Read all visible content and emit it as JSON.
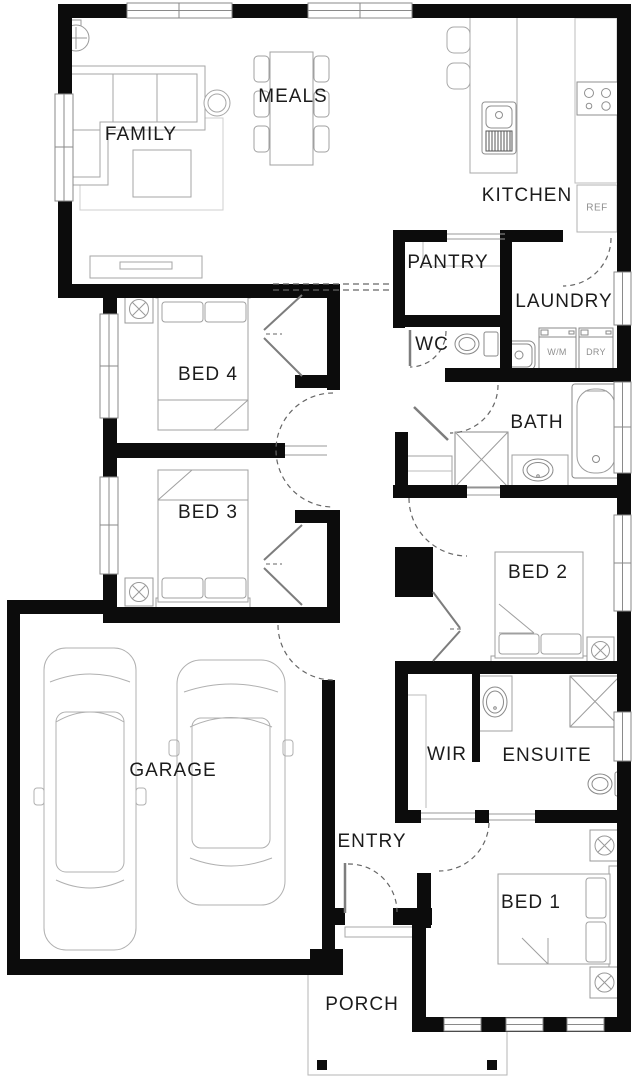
{
  "plan": {
    "rooms": {
      "family": "FAMILY",
      "meals": "MEALS",
      "kitchen": "KITCHEN",
      "pantry": "PANTRY",
      "laundry": "LAUNDRY",
      "wc": "WC",
      "bed4": "BED 4",
      "bath": "BATH",
      "bed3": "BED 3",
      "bed2": "BED 2",
      "garage": "GARAGE",
      "wir": "WIR",
      "ensuite": "ENSUITE",
      "entry": "ENTRY",
      "bed1": "BED 1",
      "porch": "PORCH"
    },
    "appliances": {
      "fridge": "REF",
      "washer": "W/M",
      "dryer": "DRY"
    },
    "colors": {
      "wall": "#0c0c0c",
      "furniture_line": "#a0a0a0",
      "fixture_line": "#8a8a8a",
      "door_dash": "#666666",
      "label": "#1c1c1c",
      "appliance_label": "#8f8f8f",
      "background": "#ffffff"
    }
  }
}
